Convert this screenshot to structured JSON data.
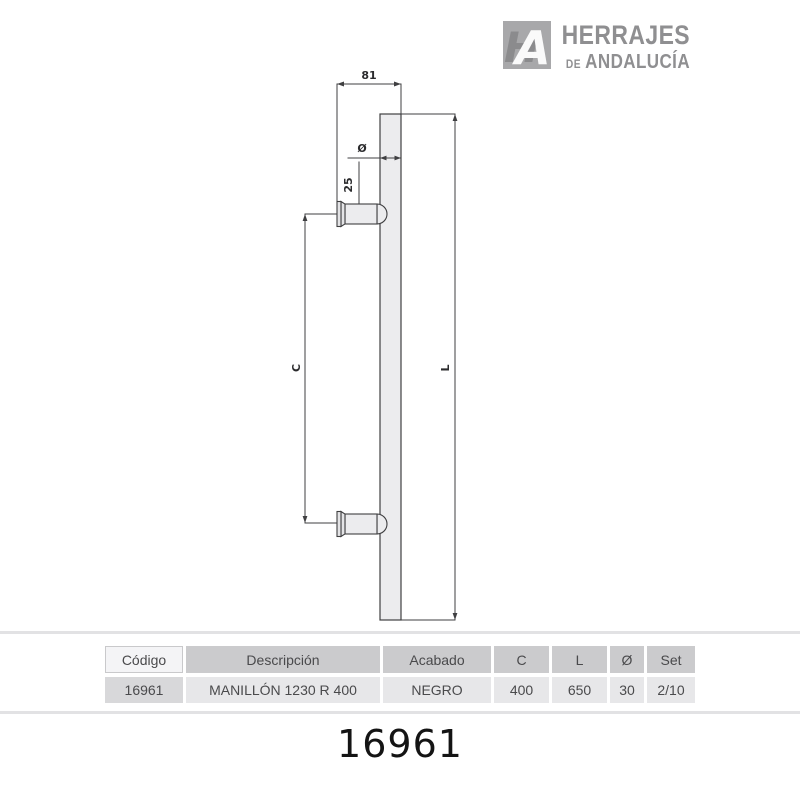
{
  "logo": {
    "icon": "ha-monogram",
    "line1": "HERRAJES",
    "line2_small": "DE",
    "line2": "ANDALUCÍA"
  },
  "drawing": {
    "labels": {
      "top_width": "81",
      "bar_diameter": "Ø",
      "post_diameter": "25",
      "center_distance": "C",
      "total_length": "L"
    }
  },
  "table": {
    "headers": [
      "Código",
      "Descripción",
      "Acabado",
      "C",
      "L",
      "Ø",
      "Set"
    ],
    "row": [
      "16961",
      "MANILLÓN 1230 R 400",
      "NEGRO",
      "400",
      "650",
      "30",
      "2/10"
    ]
  },
  "product_code": "16961",
  "colors": {
    "logo_gray": "#8f8f91",
    "line": "#3f3f41",
    "bar_fill": "#ececee",
    "header_cell": "#cbcbcd",
    "body_cell": "#e7e7e9",
    "first_header_cell": "#f4f4f6",
    "first_body_cell": "#d8d8da"
  }
}
